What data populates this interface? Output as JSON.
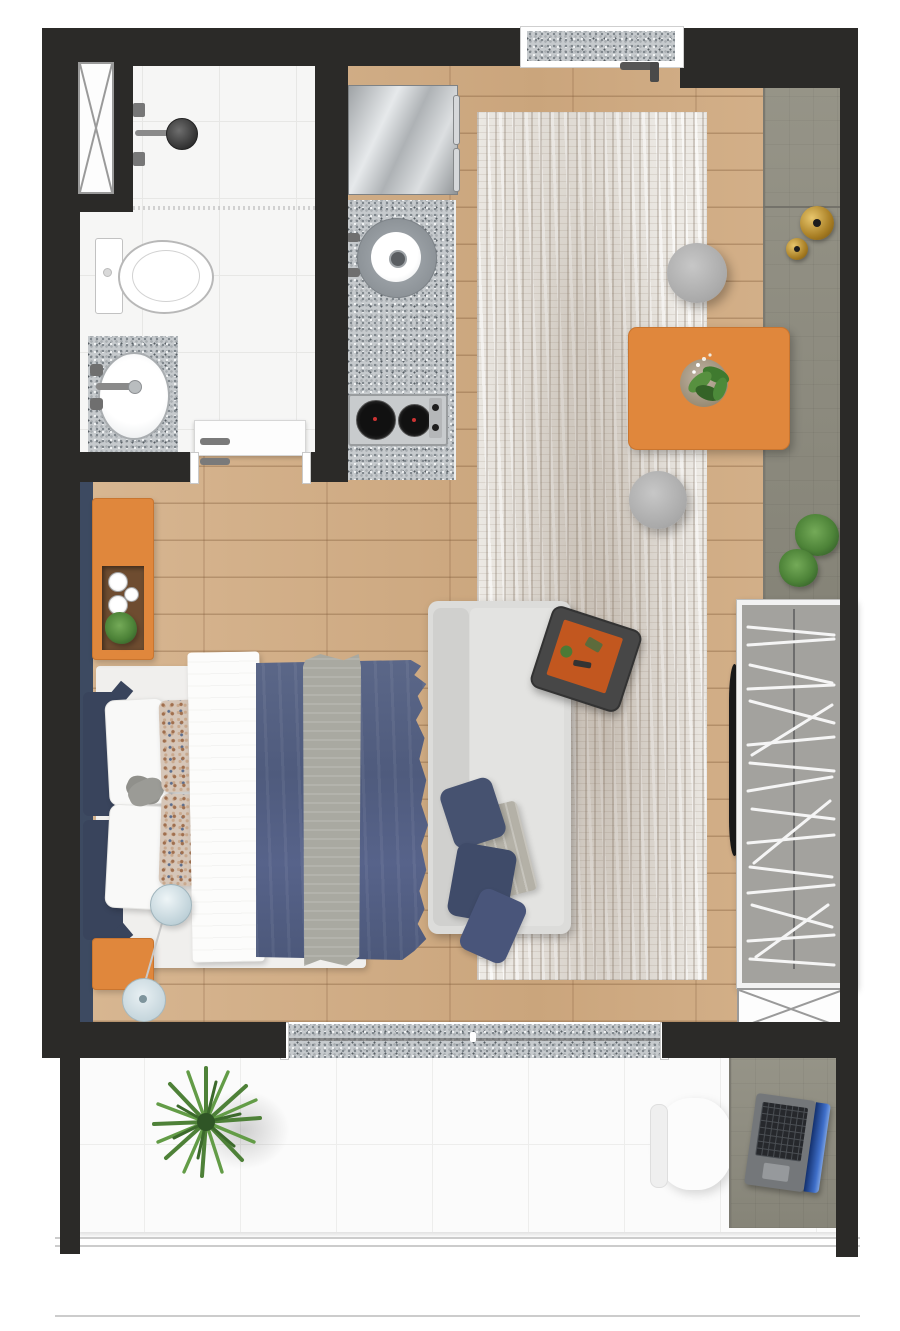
{
  "meta": {
    "kind": "floor-plan-render",
    "description": "Top-down 3D rendered floor plan of a studio apartment with bathroom, kitchenette, combined living/sleeping area, wardrobe nook and balcony",
    "visible_text": ""
  },
  "palette": {
    "wall": "#2b2a28",
    "wood-floor": "#d3ae85",
    "tile-floor": "#f6f6f5",
    "balcony-tile": "#fbfbfb",
    "rug-base": "#edeae5",
    "granite-base": "#c6cacd",
    "cabinet-olive": "#908e81",
    "accent-orange": "#e0873c",
    "headboard-navy": "#3d4a61",
    "navy-duvet": "#55618a",
    "navy-pillow": "#39445c",
    "sofa-gray": "#dcdcda",
    "blanket-gray": "#b4b1a7",
    "tv-black": "#181818",
    "gold": "#c29a3e",
    "plant-green": "#57903f",
    "lamp-blue": "#cfdfe6",
    "laptop-screen-blue": "#2a52b0",
    "tray-charcoal": "#474747",
    "tray-orange": "#c2571f"
  },
  "rooms": [
    {
      "id": "bathroom",
      "items": [
        "exhaust-shaft",
        "shower",
        "toilet",
        "vanity-sink",
        "bathroom-door"
      ]
    },
    {
      "id": "kitchenette",
      "items": [
        "refrigerator",
        "granite-counter",
        "round-sink",
        "two-burner-cooktop"
      ]
    },
    {
      "id": "entry",
      "items": [
        "entry-door-threshold",
        "door-handle"
      ]
    },
    {
      "id": "living-bedroom",
      "items": [
        "area-rug",
        "double-bed",
        "pillows",
        "duvet",
        "bed-runner",
        "orange-shelf-unit",
        "orange-nightstand",
        "floor-lamp",
        "sofa",
        "sofa-pillows",
        "serving-tray",
        "dining-table",
        "table-plant",
        "pouf-stool-1",
        "pouf-stool-2",
        "sideboard-counter",
        "decor-bowls",
        "counter-plants",
        "tv",
        "wardrobe",
        "duct-shaft",
        "sliding-door-threshold"
      ]
    },
    {
      "id": "balcony",
      "items": [
        "balcony-plant",
        "desk",
        "desk-chair",
        "laptop",
        "railing"
      ]
    }
  ]
}
